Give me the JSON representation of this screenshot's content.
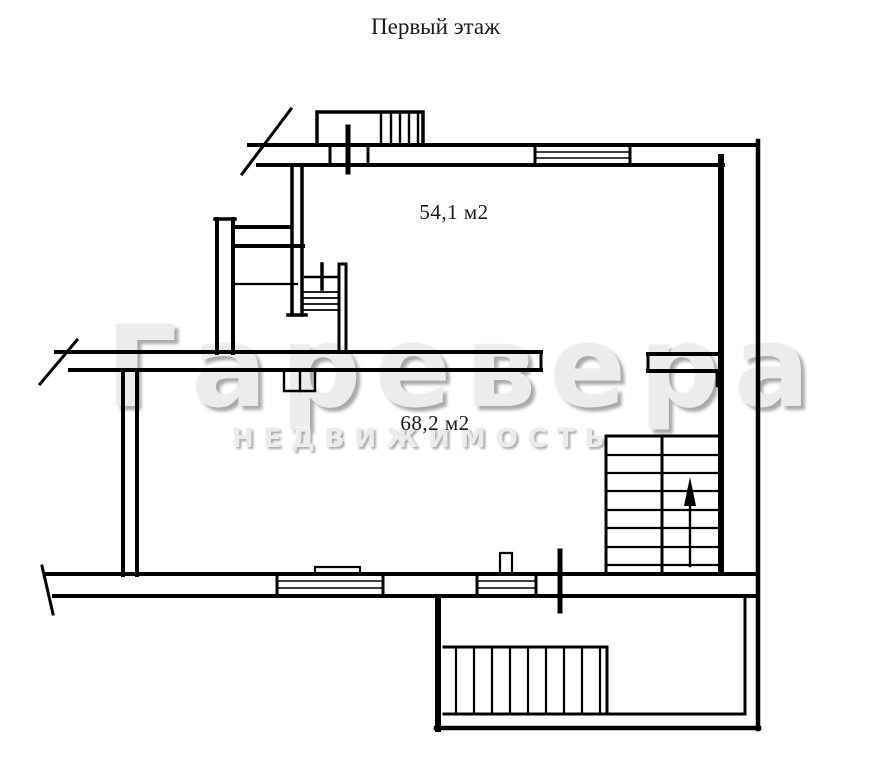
{
  "page": {
    "title": "Первый этаж"
  },
  "rooms": {
    "room1": {
      "area_label": "54,1 м2"
    },
    "room2": {
      "area_label": "68,2 м2"
    }
  },
  "watermark": {
    "brand": "Гаревера",
    "subtitle": "НЕДВИЖИМОСТЬ"
  },
  "icons": {
    "stairs_direction": "up-arrow-icon"
  },
  "colors": {
    "line": "#000000",
    "background": "#ffffff",
    "watermark_fill": "#ececec",
    "watermark_shadow": "#a9a9a9",
    "text": "#1a1a1a"
  }
}
